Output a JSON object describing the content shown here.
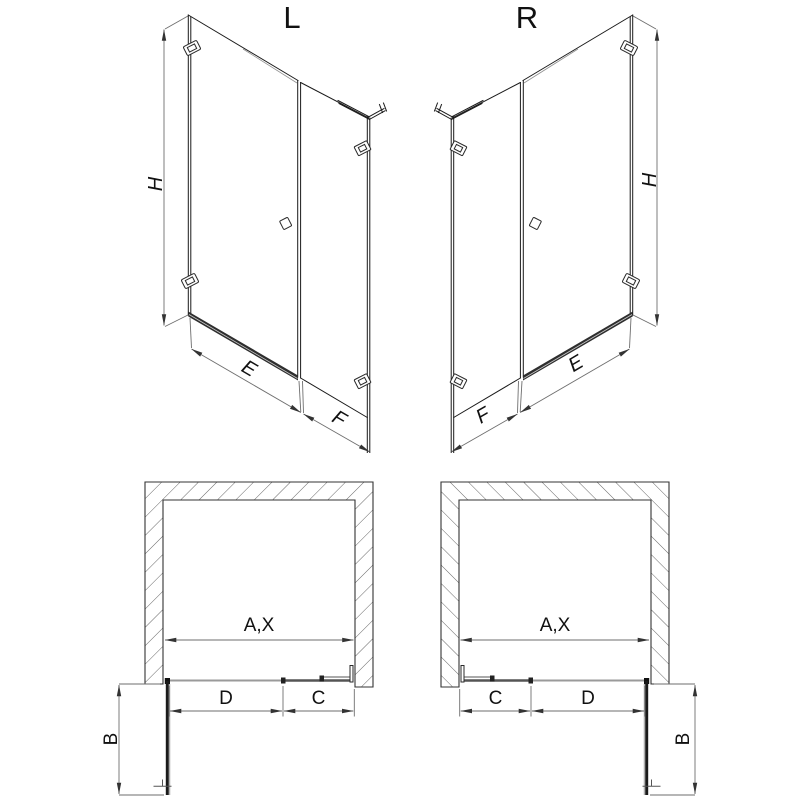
{
  "views": {
    "left": {
      "title": "L",
      "height_dim": "H",
      "door_width_dim": "E",
      "fixed_panel_dim": "F"
    },
    "right": {
      "title": "R",
      "height_dim": "H",
      "door_width_dim": "E",
      "fixed_panel_dim": "F"
    }
  },
  "plans": {
    "left": {
      "opening_dim": "A,X",
      "door_dim": "D",
      "panel_dim": "C",
      "swing_dim": "B"
    },
    "right": {
      "opening_dim": "A,X",
      "door_dim": "D",
      "panel_dim": "C",
      "swing_dim": "B"
    }
  },
  "colors": {
    "line": "#1a1a1a",
    "dimension_line": "#6e6e6e",
    "door_glass_plan": "#9a9a9a",
    "fixed_glass_plan": "#555555",
    "threshold": "#2e2e2e",
    "wall_hatch": "#565656",
    "label": "#111111",
    "background": "#ffffff"
  }
}
